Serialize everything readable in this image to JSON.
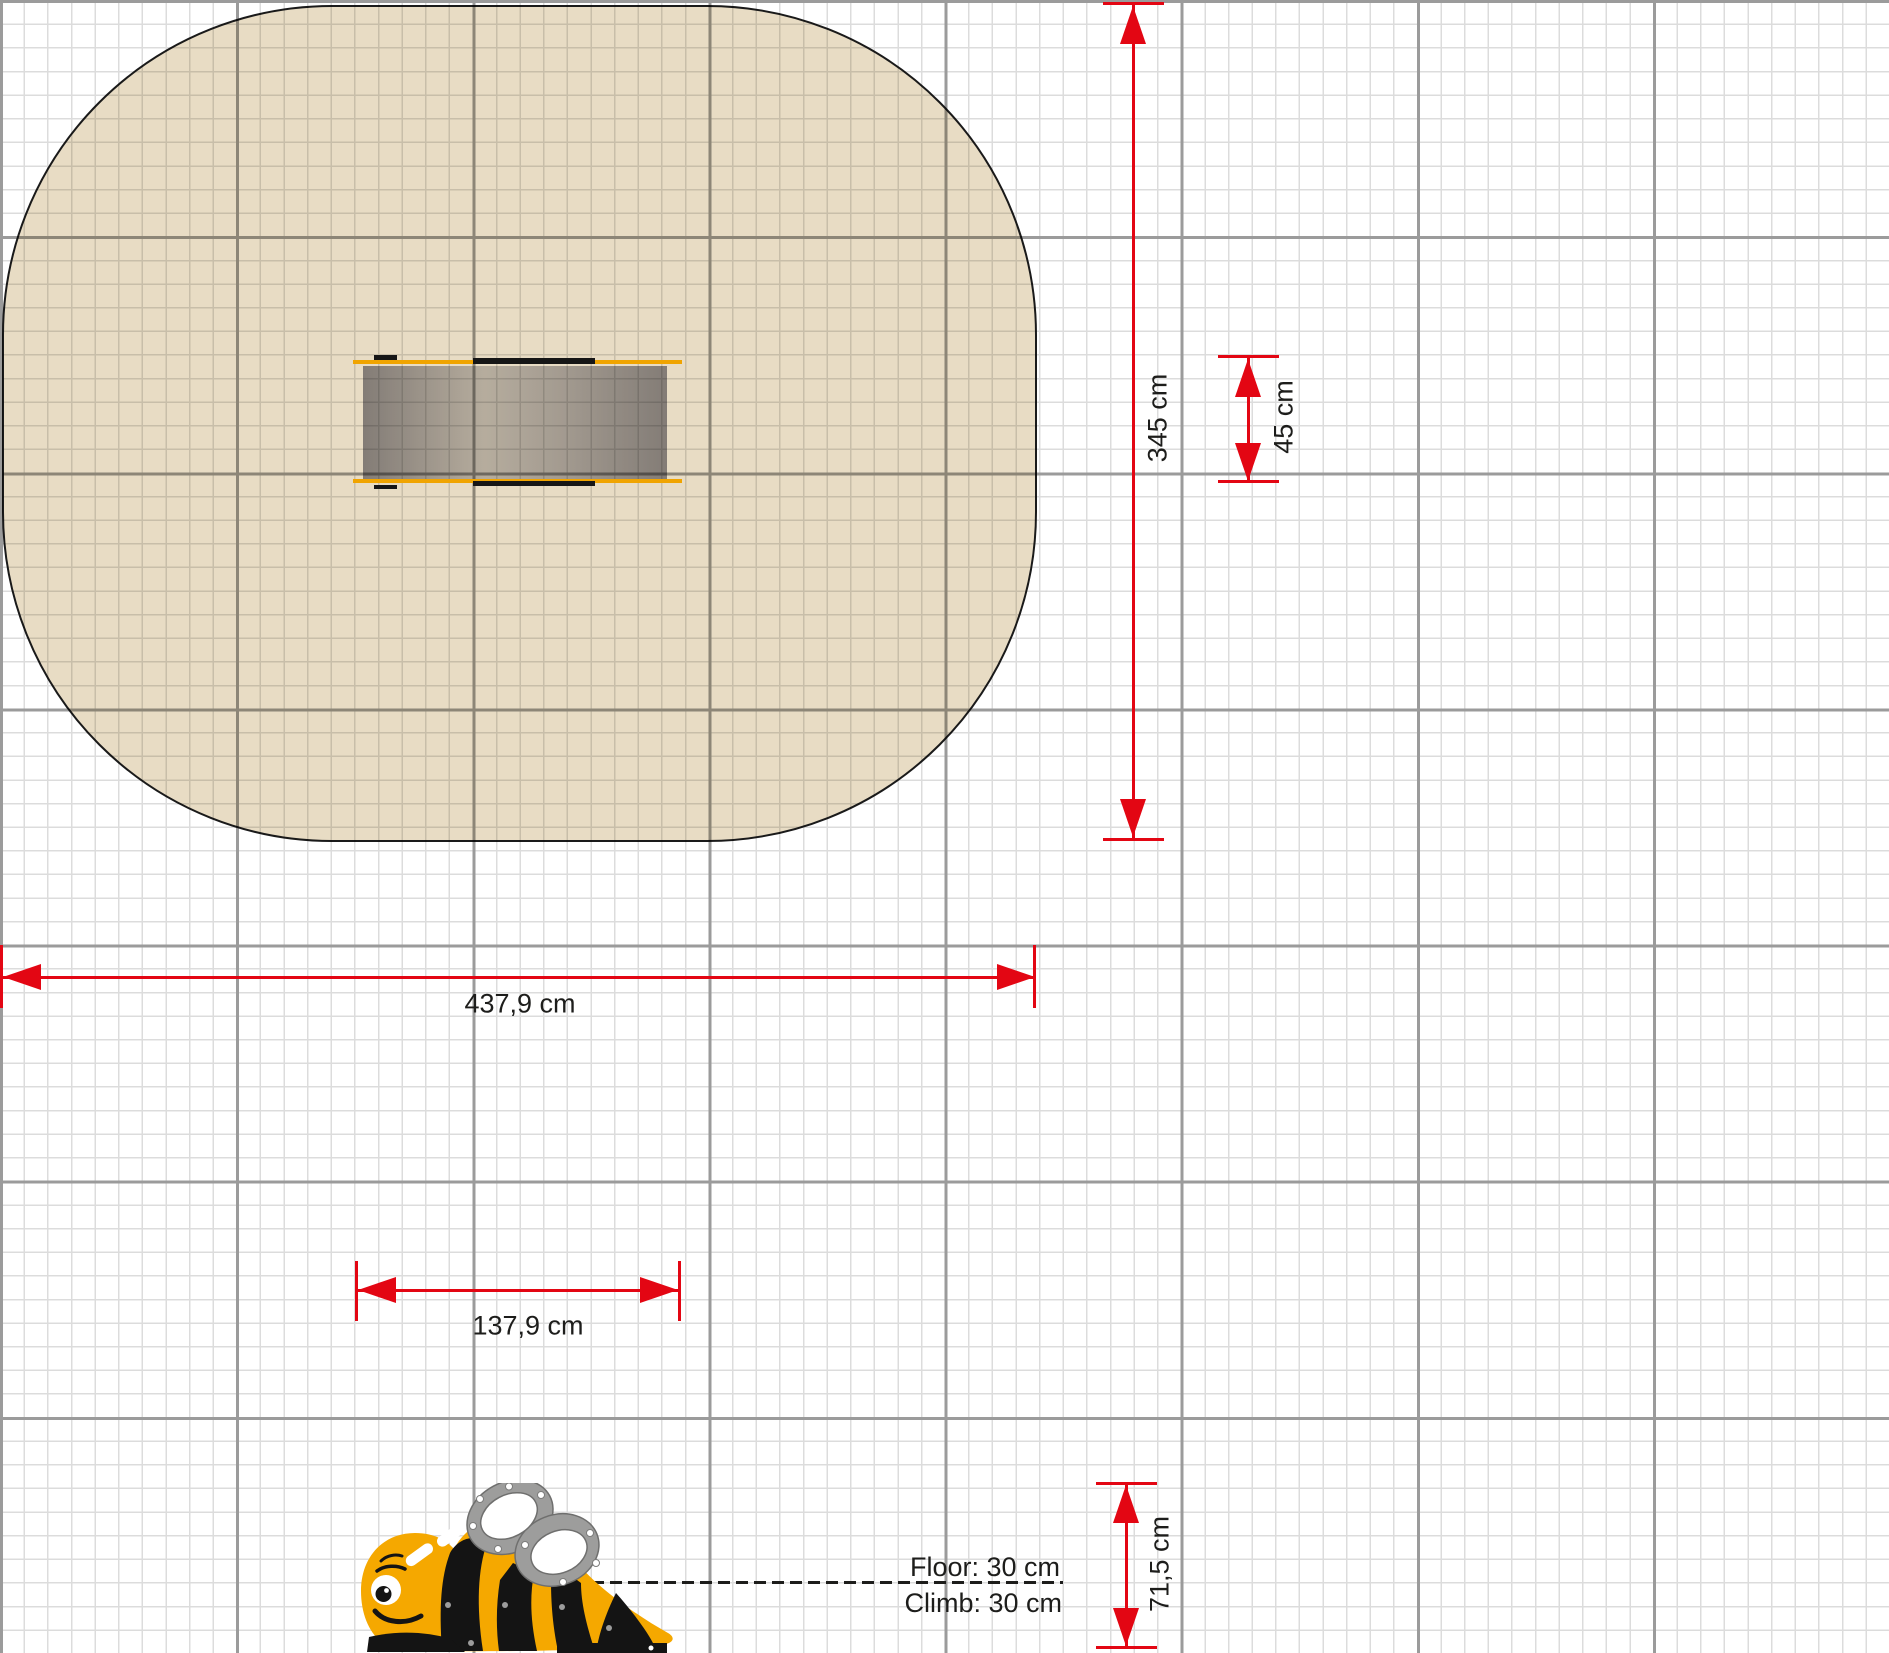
{
  "page": {
    "background": "#ffffff"
  },
  "grid": {
    "minor_spacing_px": 23.6,
    "major_spacing_px": 236.1,
    "minor_color": "#dcdcdc",
    "major_color": "#9b9b9b"
  },
  "plan_view": {
    "safety_zone": {
      "fill": "#e8dcc4",
      "outline": "#1a1a1a"
    },
    "equipment": {
      "edge_color": "#f0a400",
      "mat_color": "#b4b4bc",
      "stripe_color": "#161616"
    }
  },
  "dims": {
    "zone_height": "345 cm",
    "equip_width": "45 cm",
    "zone_width": "437,9 cm",
    "equip_length": "137,9 cm",
    "side_height": "71,5 cm"
  },
  "side_view": {
    "annotations": {
      "floor": "Floor: 30 cm",
      "climb": "Climb: 30 cm"
    },
    "bee": {
      "body_color": "#f5a800",
      "stripe_color": "#141414",
      "handle_color": "#9d9d9c"
    }
  },
  "accent_color": "#e30613"
}
